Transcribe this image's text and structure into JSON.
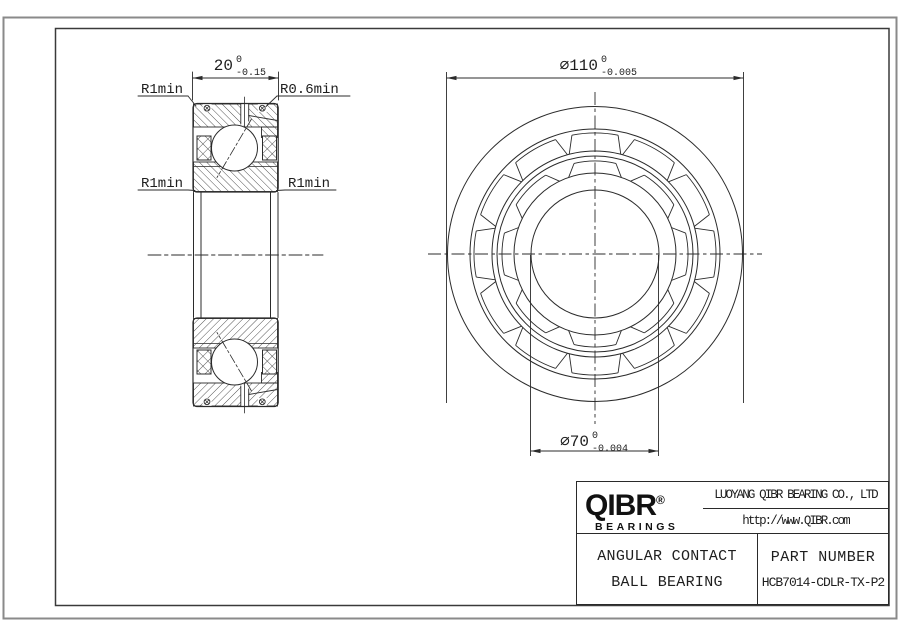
{
  "drawing": {
    "left_view": {
      "dim_width": {
        "nominal": "20",
        "sup": "0",
        "sub": "-0.15"
      },
      "labels": {
        "top_left": "R1min",
        "top_right": "R0.6min",
        "mid_left": "R1min",
        "mid_right": "R1min"
      }
    },
    "right_view": {
      "dim_od": {
        "nominal": "⌀110",
        "sup": "0",
        "sub": "-0.005"
      },
      "dim_bore": {
        "nominal": "⌀70",
        "sup": "0",
        "sub": "-0.004"
      }
    }
  },
  "title_block": {
    "logo": {
      "text": "QIBR",
      "registered": "®",
      "subtext": "BEARINGS"
    },
    "company": "LUOYANG QIBR BEARING CO., LTD",
    "website": "http://www.QIBR.com",
    "product_line1": "ANGULAR CONTACT",
    "product_line2": "BALL BEARING",
    "part_label": "PART NUMBER",
    "part_number": "HCB7014-CDLR-TX-P2"
  },
  "colors": {
    "line": "#2b2b2b",
    "border_outer": "#8a8a8a",
    "background": "#ffffff"
  }
}
